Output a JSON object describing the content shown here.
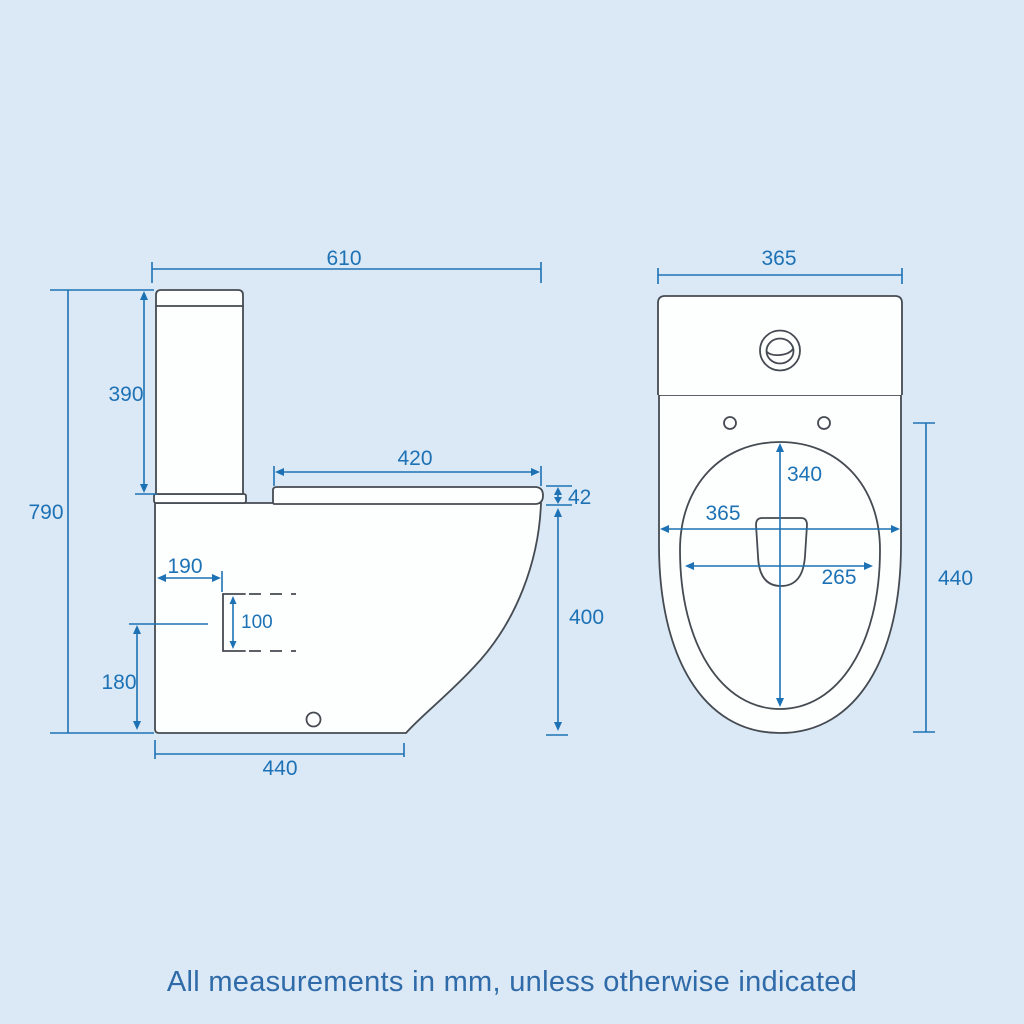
{
  "footer": {
    "note": "All measurements in mm, unless otherwise indicated"
  },
  "colors": {
    "background": "#dbe8f6",
    "outline": "#454b52",
    "dimension": "#1d72b5",
    "fill": "#fdfefe",
    "note": "#2f6ba8"
  },
  "side_view": {
    "dims": {
      "overall_depth": "610",
      "cistern_height": "390",
      "overall_height": "790",
      "seat_length": "420",
      "seat_thickness": "42",
      "bowl_height": "400",
      "outlet_setback": "190",
      "outlet_size": "100",
      "outlet_height": "180",
      "base_depth": "440"
    }
  },
  "front_view": {
    "dims": {
      "overall_width": "365",
      "bowl_length": "340",
      "rim_width": "365",
      "bowl_width": "265",
      "pan_height": "440"
    }
  }
}
